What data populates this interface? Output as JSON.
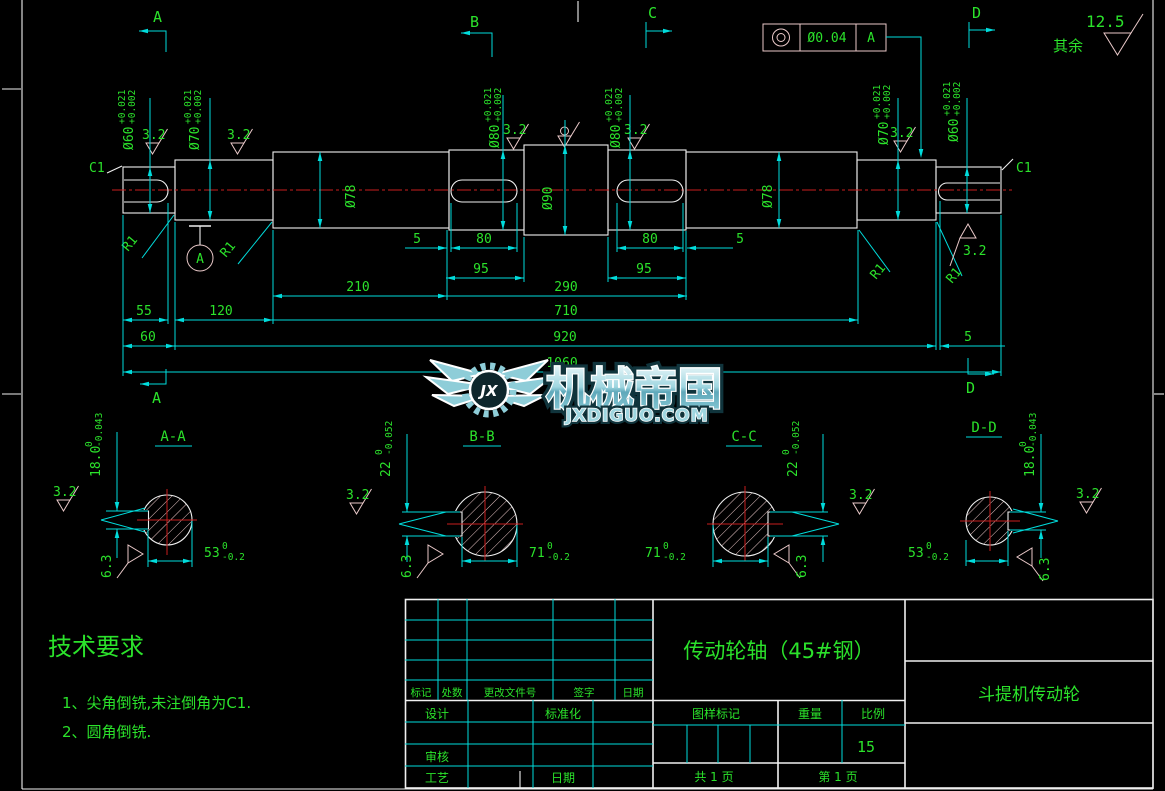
{
  "colors": {
    "background": "#000000",
    "outline_white": "#f0f0f0",
    "dimension_cyan": "#00dcdc",
    "text_green": "#2be22b",
    "centerline_red": "#c81e1e",
    "finish_pink": "#eac9c9",
    "watermark_teal": "#8ecdd8"
  },
  "finishes": {
    "fine": "3.2",
    "medium": "6.3",
    "default": "12.5",
    "default_label": "其余"
  },
  "geo_tol": {
    "symbol": "concentricity",
    "value": "Ø0.04",
    "datum": "A"
  },
  "view_letters": {
    "a": "A",
    "b": "B",
    "c": "C",
    "d": "D"
  },
  "shaft": {
    "chamfer": "C1",
    "fillet": "R1",
    "datum": "A",
    "dia": {
      "d60": "Ø60",
      "d70": "Ø70",
      "d78": "Ø78",
      "d80": "Ø80",
      "d90": "Ø90",
      "tol_up": "+0.021",
      "tol_low": "+0.002"
    },
    "len": {
      "l5": "5",
      "l55": "55",
      "l60": "60",
      "l80": "80",
      "l95": "95",
      "l120": "120",
      "l210": "210",
      "l290": "290",
      "l710": "710",
      "l920": "920",
      "l1060": "1060"
    }
  },
  "sections": {
    "aa": {
      "title": "A-A",
      "key": "18.0",
      "key_up": "0",
      "key_low": "-0.043",
      "flat": "53",
      "flat_up": "0",
      "flat_low": "-0.2"
    },
    "bb": {
      "title": "B-B",
      "key": "22",
      "key_up": "0",
      "key_low": "-0.052",
      "flat": "71",
      "flat_up": "0",
      "flat_low": "-0.2"
    },
    "cc": {
      "title": "C-C",
      "key": "22",
      "key_up": "0",
      "key_low": "-0.052",
      "flat": "71",
      "flat_up": "0",
      "flat_low": "-0.2"
    },
    "dd": {
      "title": "D-D",
      "key": "18.0",
      "key_up": "0",
      "key_low": "-0.043",
      "flat": "53",
      "flat_up": "0",
      "flat_low": "-0.2"
    }
  },
  "watermark": {
    "name": "机械帝国",
    "site": "JXDIGUO.COM",
    "logo": "JX"
  },
  "tech_req": {
    "title": "技术要求",
    "item1": "1、尖角倒铣,未注倒角为C1.",
    "item2": "2、圆角倒铣."
  },
  "title_block": {
    "part_name": "传动轮轴（45#钢）",
    "project": "斗提机传动轮",
    "rev": [
      "标记",
      "处数",
      "更改文件号",
      "签字",
      "日期"
    ],
    "design": "设计",
    "standardize": "标准化",
    "check": "审核",
    "process": "工艺",
    "date": "日期",
    "mark": "图样标记",
    "weight": "重量",
    "scale": "比例",
    "scale_value": "15",
    "total_pages": "共 1 页",
    "page_no": "第 1 页"
  }
}
